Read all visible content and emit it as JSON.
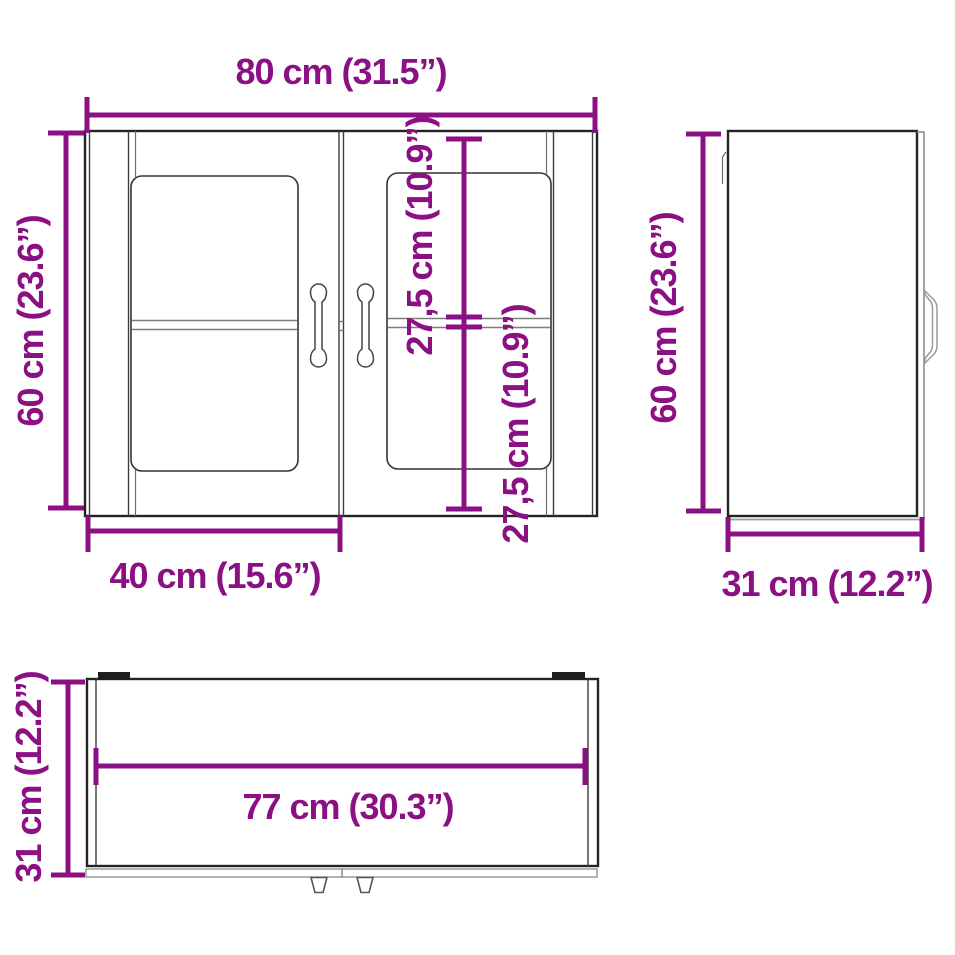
{
  "figure": {
    "background_color": "#ffffff",
    "accent_color": "#8B1083",
    "outline_color": "#232323",
    "shade_color": "#9a9a9a"
  },
  "dims": {
    "front_width": {
      "label": "80 cm (31.5”)"
    },
    "front_height": {
      "label": "60 cm (23.6”)"
    },
    "front_upper_section": {
      "label": "27,5 cm (10.9”)"
    },
    "front_lower_section": {
      "label": "27,5 cm (10.9”)"
    },
    "front_door_width": {
      "label": "40 cm (15.6”)"
    },
    "side_height": {
      "label": "60 cm (23.6”)"
    },
    "side_depth": {
      "label": "31 cm (12.2”)"
    },
    "top_depth": {
      "label": "31 cm (12.2”)"
    },
    "top_inner_width": {
      "label": "77 cm (30.3”)"
    }
  }
}
